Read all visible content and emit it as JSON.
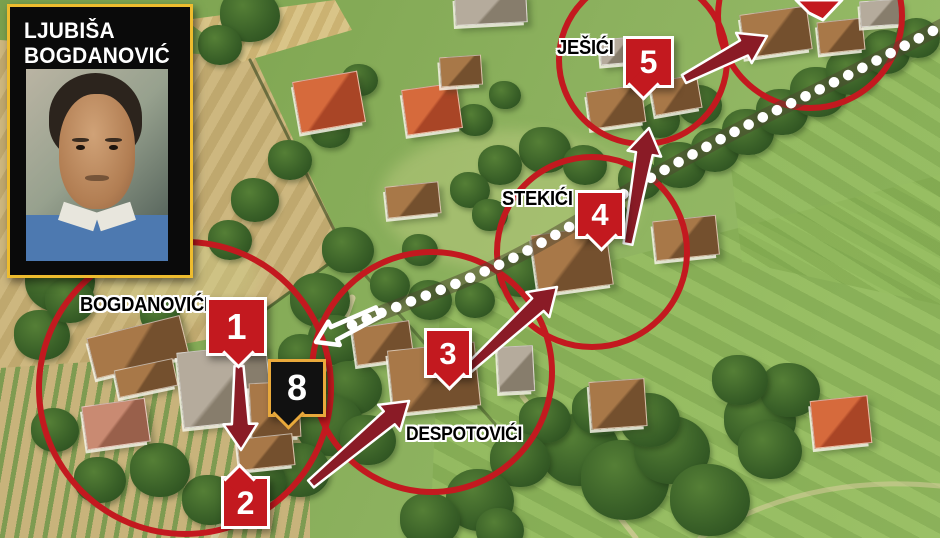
{
  "portrait": {
    "line1": "LJUBIŠA",
    "line2": "BOGDANOVIĆ"
  },
  "villages": [
    {
      "name": "village-label-bogdanovici",
      "label": "BOGDANOVIĆI",
      "x": 80,
      "y": 294,
      "fs": 20
    },
    {
      "name": "village-label-despotovici",
      "label": "DESPOTOVIĆI",
      "x": 406,
      "y": 424,
      "fs": 19
    },
    {
      "name": "village-label-stekici",
      "label": "STEKIĆI",
      "x": 502,
      "y": 188,
      "fs": 20
    },
    {
      "name": "village-label-jesici",
      "label": "JEŠIĆI",
      "x": 557,
      "y": 37,
      "fs": 20
    }
  ],
  "pins": [
    {
      "name": "pin-1",
      "label": "1",
      "x": 206,
      "y": 297,
      "w": 55,
      "h": 53,
      "style": "red",
      "pointer": "bc",
      "fs": 36
    },
    {
      "name": "pin-2",
      "label": "2",
      "x": 221,
      "y": 476,
      "w": 43,
      "h": 47,
      "style": "red",
      "pointer": "tl",
      "fs": 32
    },
    {
      "name": "pin-3",
      "label": "3",
      "x": 424,
      "y": 328,
      "w": 42,
      "h": 44,
      "style": "red",
      "pointer": "bc",
      "fs": 31
    },
    {
      "name": "pin-4",
      "label": "4",
      "x": 575,
      "y": 190,
      "w": 44,
      "h": 43,
      "style": "red",
      "pointer": "bc",
      "fs": 31
    },
    {
      "name": "pin-5",
      "label": "5",
      "x": 623,
      "y": 36,
      "w": 45,
      "h": 46,
      "style": "red",
      "pointer": "bl",
      "fs": 32
    },
    {
      "name": "pin-8",
      "label": "8",
      "x": 268,
      "y": 359,
      "w": 52,
      "h": 52,
      "style": "black",
      "pointer": "bl",
      "fs": 36
    }
  ],
  "partial_pin": {
    "name": "pin-6-partial",
    "points": "796,0 842,0 823,20 809,13"
  },
  "circles": [
    {
      "name": "circle-bogdanovici",
      "cx": 185,
      "cy": 388,
      "r": 146
    },
    {
      "name": "circle-despotovici",
      "cx": 432,
      "cy": 372,
      "r": 120
    },
    {
      "name": "circle-stekici",
      "cx": 592,
      "cy": 252,
      "r": 95
    },
    {
      "name": "circle-jesici",
      "cx": 643,
      "cy": 60,
      "r": 84
    },
    {
      "name": "circle-northeast",
      "cx": 810,
      "cy": 16,
      "r": 92
    }
  ],
  "arrows": [
    {
      "name": "arrow-1-to-2",
      "from": [
        239,
        366
      ],
      "to": [
        241,
        450
      ]
    },
    {
      "name": "arrow-to-despotovici",
      "from": [
        311,
        484
      ],
      "to": [
        409,
        401
      ]
    },
    {
      "name": "arrow-despotovici-to-stekici",
      "from": [
        468,
        369
      ],
      "to": [
        557,
        287
      ]
    },
    {
      "name": "arrow-stekici-to-jesici",
      "from": [
        628,
        244
      ],
      "to": [
        649,
        128
      ]
    },
    {
      "name": "arrow-jesici-to-northeast",
      "from": [
        684,
        79
      ],
      "to": [
        767,
        36
      ]
    }
  ],
  "white_arrow": {
    "name": "route-start-arrow",
    "from": [
      378,
      312
    ],
    "to": [
      316,
      342
    ]
  },
  "route": {
    "name": "route-dotted-path",
    "d": "M 352 325 C 410 300 470 282 532 248 C 592 215 618 196 668 168 C 718 140 760 118 806 96 C 852 74 900 48 946 24"
  },
  "terrain": {
    "roads": [
      {
        "d": "M 352 298 C 332 356 312 398 282 438 C 256 472 228 504 214 538",
        "c": "#dbcfa4",
        "w": 7,
        "o": 0.85
      },
      {
        "d": "M 522 396 C 556 438 588 478 636 538",
        "c": "#d8cc9e",
        "w": 5,
        "o": 0.7
      },
      {
        "d": "M 700 538 C 776 492 858 478 940 486",
        "c": "#d8cc9e",
        "w": 5,
        "o": 0.55
      }
    ],
    "hedges": [
      {
        "d": "M 250 60 L 345 252 L 232 334",
        "c": "rgba(60,75,35,.65)",
        "w": 3,
        "o": 1
      },
      {
        "d": "M 345 252 L 528 462",
        "c": "rgba(60,75,35,.5)",
        "w": 3,
        "o": 1
      }
    ]
  },
  "houses": [
    {
      "x": 455,
      "y": -6,
      "w": 70,
      "h": 28,
      "r": -3,
      "c": "gray"
    },
    {
      "x": 296,
      "y": 76,
      "w": 64,
      "h": 50,
      "r": -10,
      "c": "orange"
    },
    {
      "x": 404,
      "y": 86,
      "w": 54,
      "h": 44,
      "r": -8,
      "c": "orange"
    },
    {
      "x": 440,
      "y": 56,
      "w": 40,
      "h": 28,
      "r": -4,
      "c": "brown"
    },
    {
      "x": 386,
      "y": 184,
      "w": 52,
      "h": 30,
      "r": -6,
      "c": "brown"
    },
    {
      "x": 588,
      "y": 88,
      "w": 54,
      "h": 36,
      "r": -8,
      "c": "brown"
    },
    {
      "x": 652,
      "y": 78,
      "w": 46,
      "h": 32,
      "r": -10,
      "c": "brown"
    },
    {
      "x": 600,
      "y": 38,
      "w": 34,
      "h": 24,
      "r": -5,
      "c": "gray"
    },
    {
      "x": 742,
      "y": 10,
      "w": 66,
      "h": 42,
      "r": -8,
      "c": "brown"
    },
    {
      "x": 818,
      "y": 20,
      "w": 44,
      "h": 30,
      "r": -6,
      "c": "brown"
    },
    {
      "x": 860,
      "y": 0,
      "w": 40,
      "h": 24,
      "r": -4,
      "c": "gray"
    },
    {
      "x": 534,
      "y": 230,
      "w": 74,
      "h": 58,
      "r": -8,
      "c": "brown"
    },
    {
      "x": 654,
      "y": 218,
      "w": 62,
      "h": 38,
      "r": -6,
      "c": "brown"
    },
    {
      "x": 590,
      "y": 380,
      "w": 54,
      "h": 46,
      "r": -4,
      "c": "brown"
    },
    {
      "x": 354,
      "y": 324,
      "w": 56,
      "h": 36,
      "r": -8,
      "c": "brown"
    },
    {
      "x": 390,
      "y": 346,
      "w": 86,
      "h": 62,
      "r": -6,
      "c": "brown"
    },
    {
      "x": 498,
      "y": 346,
      "w": 34,
      "h": 44,
      "r": -3,
      "c": "gray"
    },
    {
      "x": 90,
      "y": 326,
      "w": 94,
      "h": 40,
      "r": -14,
      "c": "brown"
    },
    {
      "x": 116,
      "y": 364,
      "w": 58,
      "h": 26,
      "r": -12,
      "c": "brown"
    },
    {
      "x": 180,
      "y": 348,
      "w": 88,
      "h": 74,
      "r": -6,
      "c": "gray"
    },
    {
      "x": 250,
      "y": 382,
      "w": 48,
      "h": 54,
      "r": -3,
      "c": "brown"
    },
    {
      "x": 238,
      "y": 436,
      "w": 54,
      "h": 30,
      "r": -6,
      "c": "brown"
    },
    {
      "x": 84,
      "y": 402,
      "w": 62,
      "h": 42,
      "r": -8,
      "c": "pink"
    },
    {
      "x": 812,
      "y": 398,
      "w": 56,
      "h": 46,
      "r": -6,
      "c": "orange"
    }
  ],
  "trees": [
    [
      250,
      15,
      30
    ],
    [
      220,
      45,
      22
    ],
    [
      360,
      80,
      18
    ],
    [
      330,
      130,
      20
    ],
    [
      290,
      160,
      22
    ],
    [
      255,
      200,
      24
    ],
    [
      230,
      240,
      22
    ],
    [
      475,
      120,
      18
    ],
    [
      505,
      95,
      16
    ],
    [
      545,
      150,
      26
    ],
    [
      585,
      165,
      22
    ],
    [
      500,
      165,
      22
    ],
    [
      470,
      190,
      20
    ],
    [
      490,
      215,
      18
    ],
    [
      60,
      280,
      35
    ],
    [
      42,
      335,
      28
    ],
    [
      70,
      300,
      25
    ],
    [
      160,
      315,
      20
    ],
    [
      348,
      250,
      26
    ],
    [
      320,
      300,
      30
    ],
    [
      336,
      340,
      28
    ],
    [
      302,
      356,
      24
    ],
    [
      352,
      388,
      30
    ],
    [
      330,
      425,
      34
    ],
    [
      368,
      440,
      28
    ],
    [
      300,
      470,
      30
    ],
    [
      260,
      480,
      26
    ],
    [
      210,
      500,
      28
    ],
    [
      160,
      470,
      30
    ],
    [
      100,
      480,
      26
    ],
    [
      55,
      430,
      24
    ],
    [
      430,
      300,
      22
    ],
    [
      475,
      300,
      20
    ],
    [
      520,
      275,
      24
    ],
    [
      560,
      258,
      20
    ],
    [
      420,
      250,
      18
    ],
    [
      390,
      285,
      20
    ],
    [
      610,
      215,
      18
    ],
    [
      640,
      180,
      22
    ],
    [
      680,
      165,
      26
    ],
    [
      715,
      150,
      24
    ],
    [
      748,
      132,
      26
    ],
    [
      782,
      112,
      26
    ],
    [
      818,
      92,
      28
    ],
    [
      852,
      72,
      26
    ],
    [
      886,
      52,
      24
    ],
    [
      918,
      38,
      22
    ],
    [
      660,
      120,
      20
    ],
    [
      700,
      105,
      22
    ],
    [
      580,
      450,
      40
    ],
    [
      625,
      480,
      44
    ],
    [
      672,
      450,
      38
    ],
    [
      710,
      500,
      40
    ],
    [
      600,
      410,
      28
    ],
    [
      650,
      420,
      30
    ],
    [
      545,
      420,
      26
    ],
    [
      520,
      460,
      30
    ],
    [
      480,
      500,
      34
    ],
    [
      430,
      520,
      30
    ],
    [
      500,
      530,
      24
    ],
    [
      760,
      420,
      36
    ],
    [
      790,
      390,
      30
    ],
    [
      770,
      450,
      32
    ],
    [
      740,
      380,
      28
    ]
  ],
  "colors": {
    "annotation_red": "#c3191f",
    "arrow_maroon": "#8a1b26",
    "pin_red": "#c3191f",
    "pin_black_bg": "#111111",
    "pin_gold_border": "#e9a93b",
    "route_dot": "#ffffff",
    "road_band": "rgba(78,70,48,0.5)",
    "label_text": "#000000",
    "label_outline": "#ffffff",
    "portrait_border": "#eebc2e",
    "portrait_bg": "#0a0a0a",
    "portrait_text": "#ffffff"
  },
  "roof_palette": {
    "orange": [
      "#d66a3c",
      "#a94526"
    ],
    "brown": [
      "#a87848",
      "#74502e"
    ],
    "gray": [
      "#b5ab9c",
      "#877d6c"
    ],
    "pink": [
      "#c98a72",
      "#99604b"
    ]
  }
}
